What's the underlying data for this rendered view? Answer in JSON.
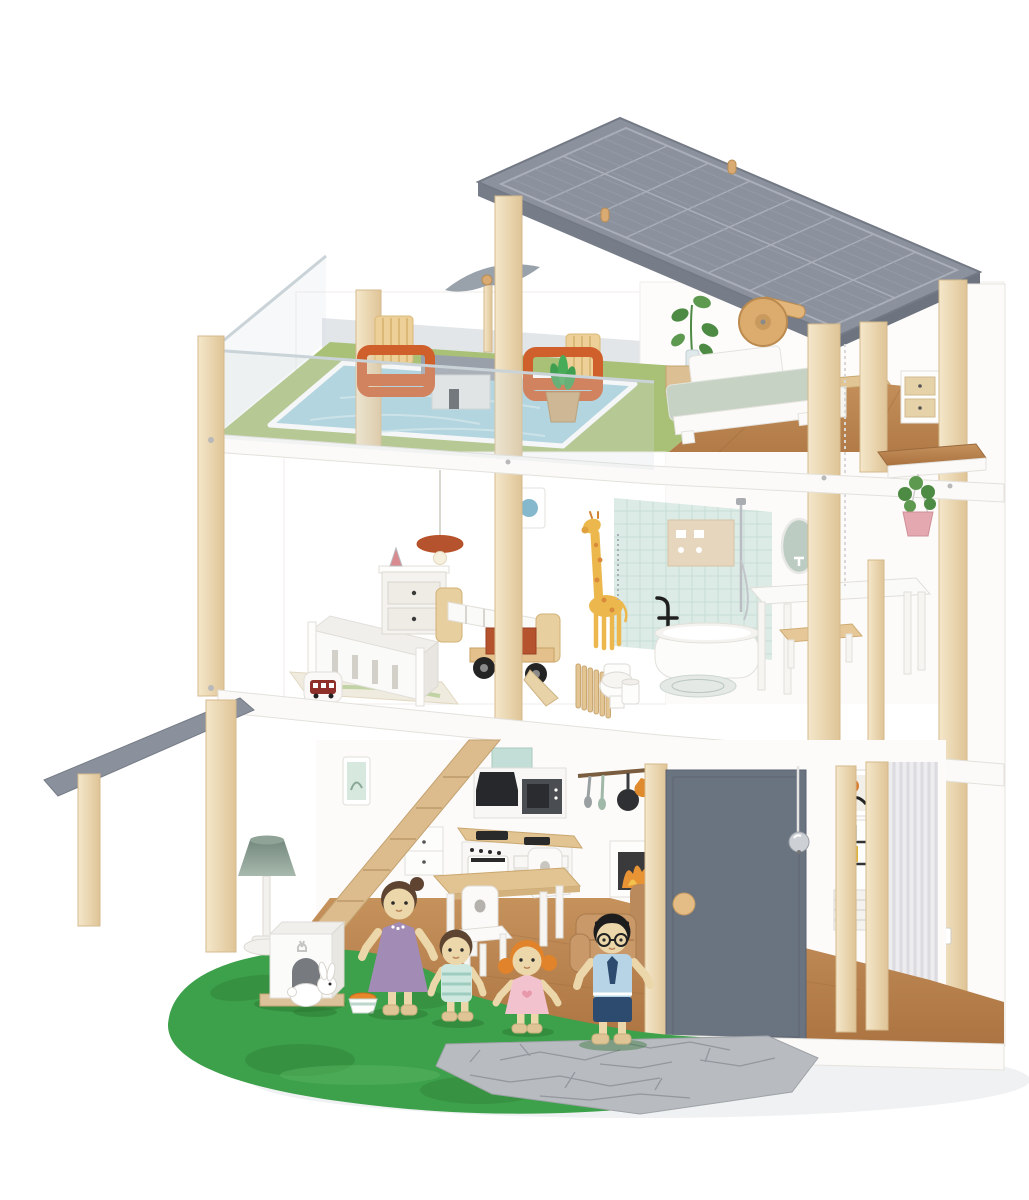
{
  "meta": {
    "type": "product-photo",
    "description": "Three-storey wooden toy dollhouse with slanted solar-panel roof, rooftop pool terrace with wind turbine, bedroom, nursery and bathroom with elevator pulley, ground-floor kitchen and living room, grey front door with doorbell, carport awning, green garden base with stone path, pet house with rabbit and a four-figure wooden doll family.",
    "background": "#ffffff"
  },
  "labels": {
    "base_tag": "39"
  },
  "palette": {
    "white": "#fbfaf8",
    "wood": "#ecd9b6",
    "wood_edge": "#d4b98c",
    "floor_wood": "#b5804e",
    "roof": "#8b919d",
    "roof_line": "#a9aeb8",
    "awning": "#8b919c",
    "door": "#6a7380",
    "door_knob": "#e3bd85",
    "grass": "#3da04a",
    "grass_dark": "#2f8038",
    "path": "#b8bbbf",
    "pool": "#a6d2de",
    "terrace": "#a9c077",
    "tile": "#dcebe6",
    "orange": "#cf5f2b",
    "cushion": "#ecd098",
    "sofa": "#c9996a",
    "mattress": "#c6d2c4",
    "lamp_shade": "#8fa396",
    "truck_red": "#b5532e",
    "flame": "#e89434",
    "skin": "#ecd7ab",
    "mom_dress": "#a28bb4",
    "boy_shirt": "#cfe8df",
    "girl_dress": "#f2c3ce",
    "dad_shirt": "#b7d4e7",
    "dad_navy": "#2d4b6e",
    "plant": "#4d8a43"
  },
  "house": {
    "roof": {
      "type": "solar panel",
      "accessories": [
        "wooden pegs",
        "pulley wheel"
      ]
    },
    "floors": [
      {
        "name": "rooftop",
        "rooms": [
          "pool terrace",
          "bedroom"
        ],
        "items": [
          "wind turbine",
          "acrylic railing",
          "swimming pool",
          "orange armchair",
          "orange armchair",
          "potted cactus",
          "roof shed",
          "double bed",
          "potted plant",
          "nightstand",
          "desk",
          "drawer unit"
        ]
      },
      {
        "name": "middle",
        "rooms": [
          "nursery",
          "bathroom"
        ],
        "items": [
          "crib",
          "rug",
          "dresser",
          "stacking toy",
          "pendant lamp",
          "toy bus",
          "kids bed",
          "toy truck",
          "giraffe growth chart",
          "wall picture",
          "garden fence",
          "toilet",
          "bathtub",
          "faucet decal",
          "bath mat",
          "shower set",
          "mirror",
          "side table",
          "stool",
          "trash bin",
          "hanging plant",
          "elevator rope",
          "wall shelf"
        ]
      },
      {
        "name": "ground",
        "rooms": [
          "kitchen",
          "living room",
          "side room",
          "front yard"
        ],
        "items": [
          "staircase",
          "range hood",
          "microwave",
          "utensil rack",
          "stove",
          "under-stairs cabinet",
          "dining table",
          "heart chair",
          "heart chair",
          "sofa",
          "fireplace",
          "floor lamp",
          "pet house",
          "rabbit",
          "food bowl",
          "grey front door",
          "doorbell",
          "bookshelf",
          "wall art",
          "carport awning",
          "stone path",
          "grass base"
        ]
      }
    ],
    "family": [
      {
        "role": "mom",
        "outfit": "purple dress with necklace",
        "hair": "brown bun"
      },
      {
        "role": "boy",
        "outfit": "mint striped shirt",
        "hair": "brown"
      },
      {
        "role": "girl",
        "outfit": "pink dress with heart",
        "hair": "orange pigtails"
      },
      {
        "role": "dad",
        "outfit": "blue shirt, tie and navy shorts, glasses",
        "hair": "black"
      }
    ]
  }
}
